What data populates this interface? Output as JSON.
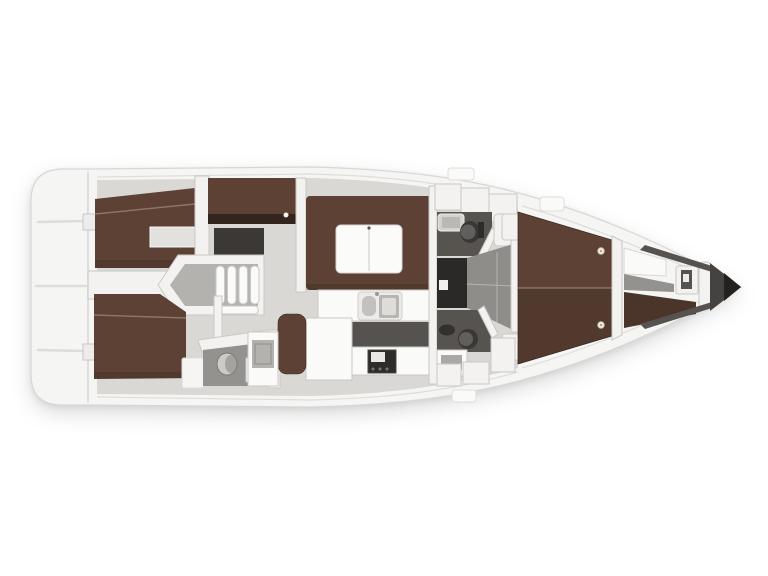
{
  "diagram": {
    "type": "yacht-interior-layout-plan",
    "orientation": "bow-right",
    "regions": [
      "swim-platform-transom",
      "aft-cabin-top",
      "aft-cabin-bottom",
      "companionway-steps",
      "salon-u-settee",
      "salon-folding-table",
      "sideboard",
      "galley-counter",
      "galley-sink",
      "galley-stove",
      "nav-seat",
      "chart-table",
      "aft-head-bottom",
      "head-top",
      "shower-mid",
      "passage-mid",
      "forward-v-berth",
      "reading-lights",
      "crew-bow-berth",
      "bow-cabinet",
      "bow-tip"
    ]
  },
  "colors": {
    "background": "#ffffff",
    "hull_white": "#f5f5f3",
    "hull_outline": "#d8d7d4",
    "deck_seam": "#deddda",
    "sole_gray": "#d9d8d4",
    "wall_white": "#f3f2f0",
    "wall_stroke": "#c9c8c5",
    "wood_brown": "#5d4134",
    "wood_dark": "#4b342a",
    "wood_front_dark": "#33251d",
    "floor_dark": "#57544f",
    "floor_mid": "#8f8d8a",
    "shower_dark": "#2b2927",
    "fixture_white": "#fafaf9",
    "fixture_gray": "#b3b2af",
    "stove_dark": "#2e2c2a",
    "bow_shadow": "#454240",
    "bow_deep": "#232120",
    "light_warm": "#caa15a",
    "toilet_dark": "#3a3836",
    "toilet_lid": "#615e5b",
    "bath_floor": "#94928e"
  }
}
